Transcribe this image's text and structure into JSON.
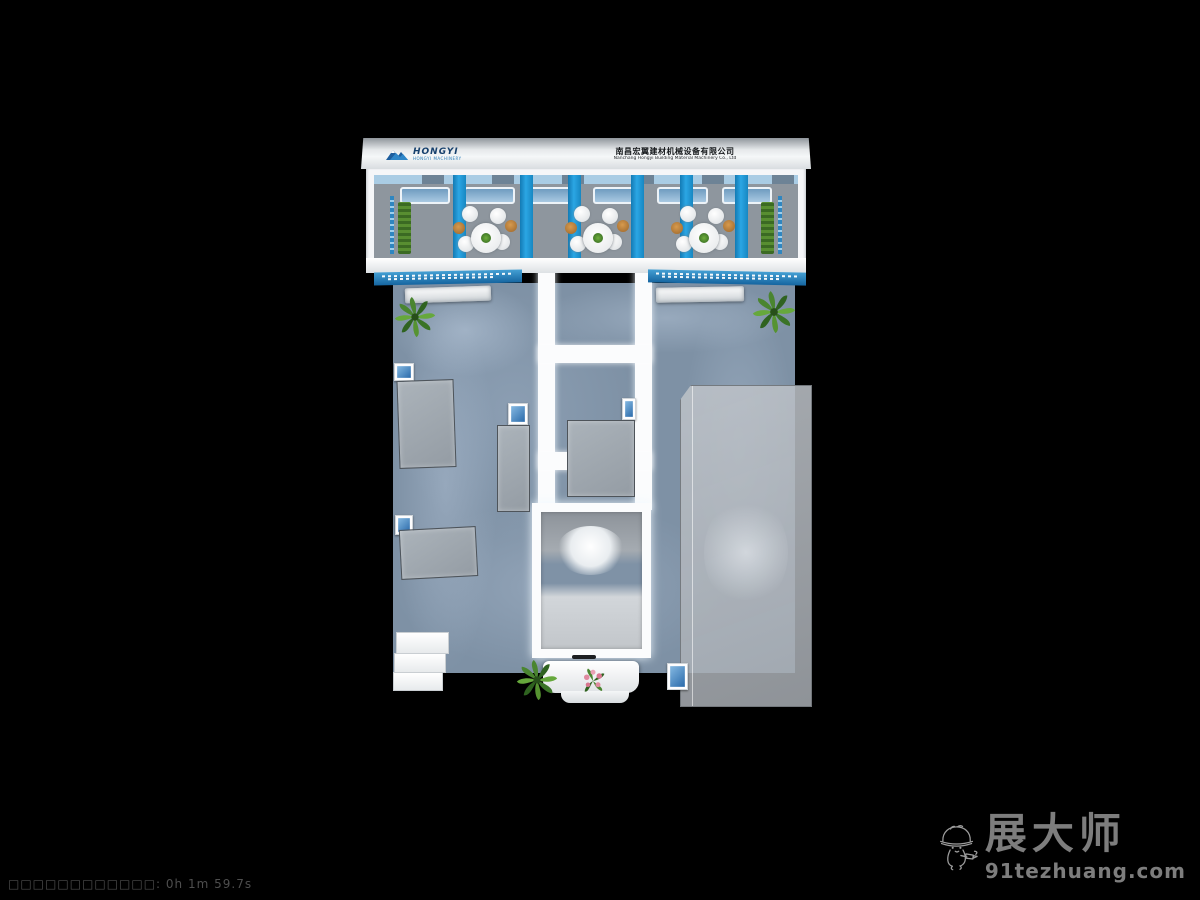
{
  "scene": {
    "type": "3d-render-top-view-exhibition-booth",
    "background": "#000000"
  },
  "render_status": {
    "text": "□□□□□□□□□□□□: 0h 1m 59.7s"
  },
  "watermark": {
    "brand": "展大师",
    "site": "91tezhuang.com",
    "mascot": "construction-mascot-hard-hat-drill",
    "color": "#7d7d7d"
  },
  "booth": {
    "header": {
      "logo_text": "HONGYI",
      "logo_tagline": "HONGYI MACHINERY",
      "company_cn": "南昌宏翼建材机械设备有限公司",
      "company_en": "Nanchang Hongyi Building Material Machinery Co., Ltd"
    },
    "features": {
      "pillar_count": 6,
      "table_groups": 3,
      "ceiling_panels": 6,
      "render_time": "0h 1m 59.7s"
    },
    "colors": {
      "pillar_blue": "#1f9cd8",
      "signage_blue": "#2a7db8",
      "carpet_blue_gray": "#7e91a5",
      "upper_floor_gray": "#8e969e",
      "structure_white": "#f7f8f9",
      "cabinet_gray": "#9aa2aa",
      "hedge_green": "#4e7d2e",
      "glass_box_gray": "#aab0b6",
      "stool_orange": "#c08038"
    }
  }
}
